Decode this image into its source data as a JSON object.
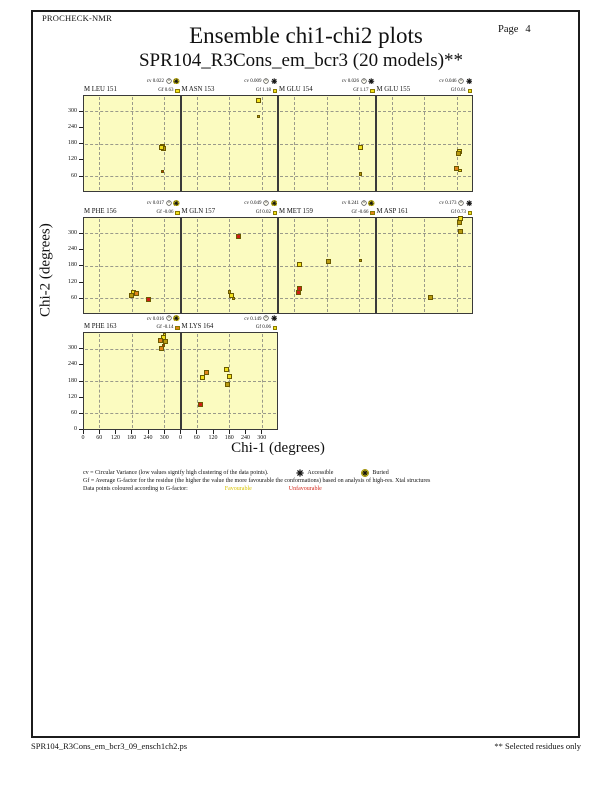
{
  "page": {
    "app": "PROCHECK-NMR",
    "page_label": "Page",
    "page_number": "4",
    "title": "Ensemble chi1-chi2 plots",
    "subtitle": "SPR104_R3Cons_em_bcr3 (20 models)**",
    "footer_left": "SPR104_R3Cons_em_bcr3_09_ensch1ch2.ps",
    "footer_right": "** Selected residues only"
  },
  "axes": {
    "x_label": "Chi-1 (degrees)",
    "y_label": "Chi-2 (degrees)",
    "x_ticks": [
      0,
      60,
      120,
      180,
      240,
      300
    ],
    "y_ticks": [
      0,
      60,
      120,
      180,
      240,
      300
    ]
  },
  "legend": {
    "line1": "cv = Circular Variance (low values signify high clustering of the data points).",
    "accessible_label": "Accessible",
    "buried_label": "Buried",
    "line2": "Gf = Average G-factor for the residue (the higher the value the more favourable the conformations)  based on analysis of high-res. Xtal structures",
    "line3": "Data points coloured according to G-factor:",
    "favourable_label": "Favourable",
    "unfavourable_label": "Unfavourable"
  },
  "colors": {
    "plot_bg": "#fbfbc0",
    "favourable": "#f2e11c",
    "unfavourable": "#d42015",
    "point_yellow": "#f2e11c",
    "point_olive": "#b99b10",
    "point_orange": "#e0841a",
    "point_red": "#cf1f15"
  },
  "chart_data": {
    "type": "scatter",
    "title": "Ensemble chi1-chi2 plots",
    "xlabel": "Chi-1 (degrees)",
    "ylabel": "Chi-2 (degrees)",
    "xlim": [
      0,
      360
    ],
    "ylim": [
      0,
      360
    ],
    "x_ticks": [
      0,
      60,
      120,
      180,
      240,
      300
    ],
    "y_ticks": [
      0,
      60,
      120,
      180,
      240,
      300
    ],
    "grid_lines_at": [
      60,
      180,
      300
    ],
    "grid_style": "dashed",
    "point_color_meaning": "G-factor: yellow favourable, red unfavourable",
    "subplots": [
      {
        "residue": "M LEU 151",
        "cv": "0.022",
        "gf": "0.63",
        "access": "buried",
        "gf_color": "favourable",
        "row": 0,
        "col": 0,
        "points": [
          {
            "x": 295,
            "y": 168,
            "c": "yellow"
          },
          {
            "x": 299,
            "y": 162,
            "c": "olive"
          },
          {
            "x": 291,
            "y": 165,
            "c": "yellow"
          },
          {
            "x": 293,
            "y": 78,
            "c": "red",
            "s": 1
          }
        ]
      },
      {
        "residue": "M ASN 153",
        "cv": "0.009",
        "gf": "1.18",
        "access": "accessible",
        "gf_color": "favourable",
        "row": 0,
        "col": 1,
        "points": [
          {
            "x": 288,
            "y": 338,
            "c": "yellow"
          },
          {
            "x": 287,
            "y": 280,
            "c": "olive",
            "s": 1
          }
        ]
      },
      {
        "residue": "M GLU 154",
        "cv": "0.026",
        "gf": "1.17",
        "access": "accessible",
        "gf_color": "favourable",
        "row": 0,
        "col": 2,
        "points": [
          {
            "x": 304,
            "y": 164,
            "c": "yellow"
          },
          {
            "x": 305,
            "y": 68,
            "c": "olive",
            "s": 1
          }
        ]
      },
      {
        "residue": "M GLU 155",
        "cv": "0.046",
        "gf": "0.61",
        "access": "accessible",
        "gf_color": "favourable",
        "row": 0,
        "col": 3,
        "points": [
          {
            "x": 310,
            "y": 150,
            "c": "yellow"
          },
          {
            "x": 305,
            "y": 143,
            "c": "olive"
          },
          {
            "x": 300,
            "y": 88,
            "c": "orange"
          },
          {
            "x": 312,
            "y": 80,
            "c": "yellow",
            "s": 1
          }
        ]
      },
      {
        "residue": "M PHE 156",
        "cv": "0.017",
        "gf": "-0.06",
        "access": "buried",
        "gf_color": "favourable",
        "row": 1,
        "col": 0,
        "points": [
          {
            "x": 186,
            "y": 80,
            "c": "yellow"
          },
          {
            "x": 198,
            "y": 76,
            "c": "orange"
          },
          {
            "x": 178,
            "y": 72,
            "c": "olive"
          },
          {
            "x": 241,
            "y": 54,
            "c": "red"
          }
        ]
      },
      {
        "residue": "M GLN 157",
        "cv": "0.049",
        "gf": "0.02",
        "access": "buried",
        "gf_color": "favourable",
        "row": 1,
        "col": 1,
        "points": [
          {
            "x": 213,
            "y": 288,
            "c": "red"
          },
          {
            "x": 187,
            "y": 72,
            "c": "yellow"
          },
          {
            "x": 180,
            "y": 83,
            "c": "olive",
            "s": 1
          },
          {
            "x": 195,
            "y": 58,
            "c": "olive",
            "s": 1
          }
        ]
      },
      {
        "residue": "M MET 159",
        "cv": "0.241",
        "gf": "-0.66",
        "access": "buried",
        "gf_color": "unfavourable",
        "row": 1,
        "col": 2,
        "points": [
          {
            "x": 78,
            "y": 184,
            "c": "yellow"
          },
          {
            "x": 186,
            "y": 195,
            "c": "olive"
          },
          {
            "x": 304,
            "y": 199,
            "c": "olive",
            "s": 1
          },
          {
            "x": 78,
            "y": 98,
            "c": "red"
          },
          {
            "x": 77,
            "y": 82,
            "c": "red"
          }
        ]
      },
      {
        "residue": "M ASP 161",
        "cv": "0.173",
        "gf": "0.73",
        "access": "accessible",
        "gf_color": "favourable",
        "row": 1,
        "col": 3,
        "points": [
          {
            "x": 313,
            "y": 355,
            "c": "yellow"
          },
          {
            "x": 309,
            "y": 342,
            "c": "olive"
          },
          {
            "x": 315,
            "y": 306,
            "c": "olive"
          },
          {
            "x": 202,
            "y": 64,
            "c": "olive"
          }
        ]
      },
      {
        "residue": "M PHE 163",
        "cv": "0.016",
        "gf": "-0.14",
        "access": "buried",
        "gf_color": "unfavourable",
        "row": 2,
        "col": 0,
        "points": [
          {
            "x": 297,
            "y": 342,
            "c": "yellow"
          },
          {
            "x": 287,
            "y": 330,
            "c": "orange"
          },
          {
            "x": 303,
            "y": 326,
            "c": "olive"
          },
          {
            "x": 291,
            "y": 300,
            "c": "orange"
          },
          {
            "x": 297,
            "y": 312,
            "c": "red",
            "s": 1
          },
          {
            "x": 302,
            "y": 352,
            "c": "yellow",
            "s": 1
          }
        ]
      },
      {
        "residue": "M LYS 164",
        "cv": "0.149",
        "gf": "0.06",
        "access": "accessible",
        "gf_color": "favourable",
        "row": 2,
        "col": 1,
        "points": [
          {
            "x": 83,
            "y": 192,
            "c": "yellow"
          },
          {
            "x": 97,
            "y": 210,
            "c": "orange"
          },
          {
            "x": 169,
            "y": 221,
            "c": "yellow"
          },
          {
            "x": 180,
            "y": 196,
            "c": "yellow"
          },
          {
            "x": 172,
            "y": 168,
            "c": "olive"
          },
          {
            "x": 72,
            "y": 95,
            "c": "red"
          }
        ]
      }
    ]
  }
}
